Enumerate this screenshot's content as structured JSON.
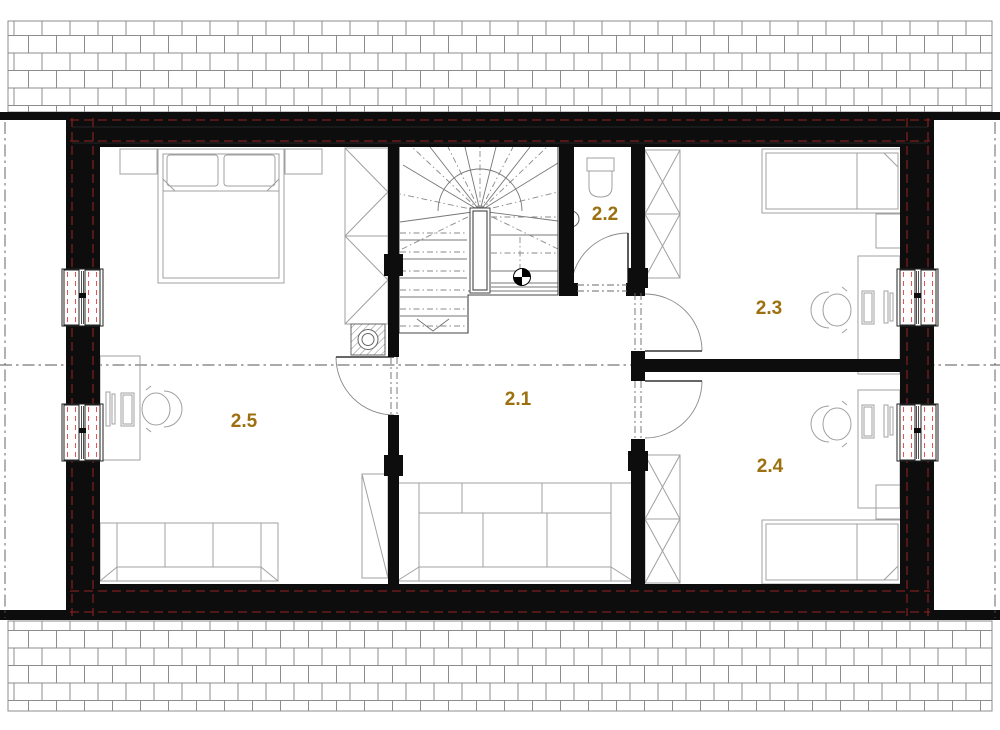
{
  "rooms": [
    {
      "label": "2.1"
    },
    {
      "label": "2.2"
    },
    {
      "label": "2.3"
    },
    {
      "label": "2.4"
    },
    {
      "label": "2.5"
    }
  ],
  "colors": {
    "room_label": "#9c700f",
    "walls": "#0d0d0d",
    "insulation_dashes": "#7b1e1e",
    "window_frame_dashes": "#e25555",
    "background": "#ffffff"
  }
}
